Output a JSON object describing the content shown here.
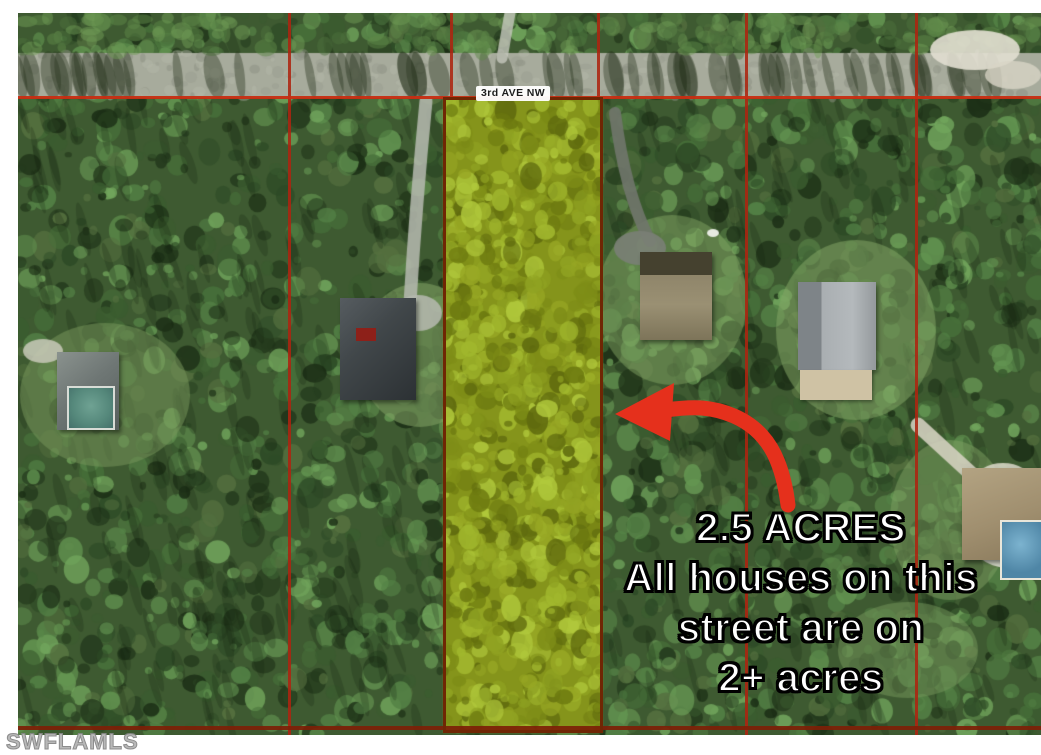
{
  "street": {
    "label": "3rd AVE NW"
  },
  "annotation": {
    "lines": [
      "2.5 ACRES",
      "All houses on this",
      "street are on",
      "2+ acres"
    ],
    "text_color": "#ffffff",
    "outline_color": "#000000"
  },
  "watermark": {
    "text": "SWFLAMLS",
    "color": "#b5b5b5"
  },
  "colors": {
    "parcel_line": "#ad2410",
    "street_line": "#c62d12",
    "bottom_line": "#7d1f06",
    "highlight_fill": "#85941b",
    "highlight_border": "#6f2604",
    "arrow": "#e5301c",
    "forest_base": "#3e5a31",
    "road": "#a7ab9c",
    "frame": "#ffffff"
  }
}
